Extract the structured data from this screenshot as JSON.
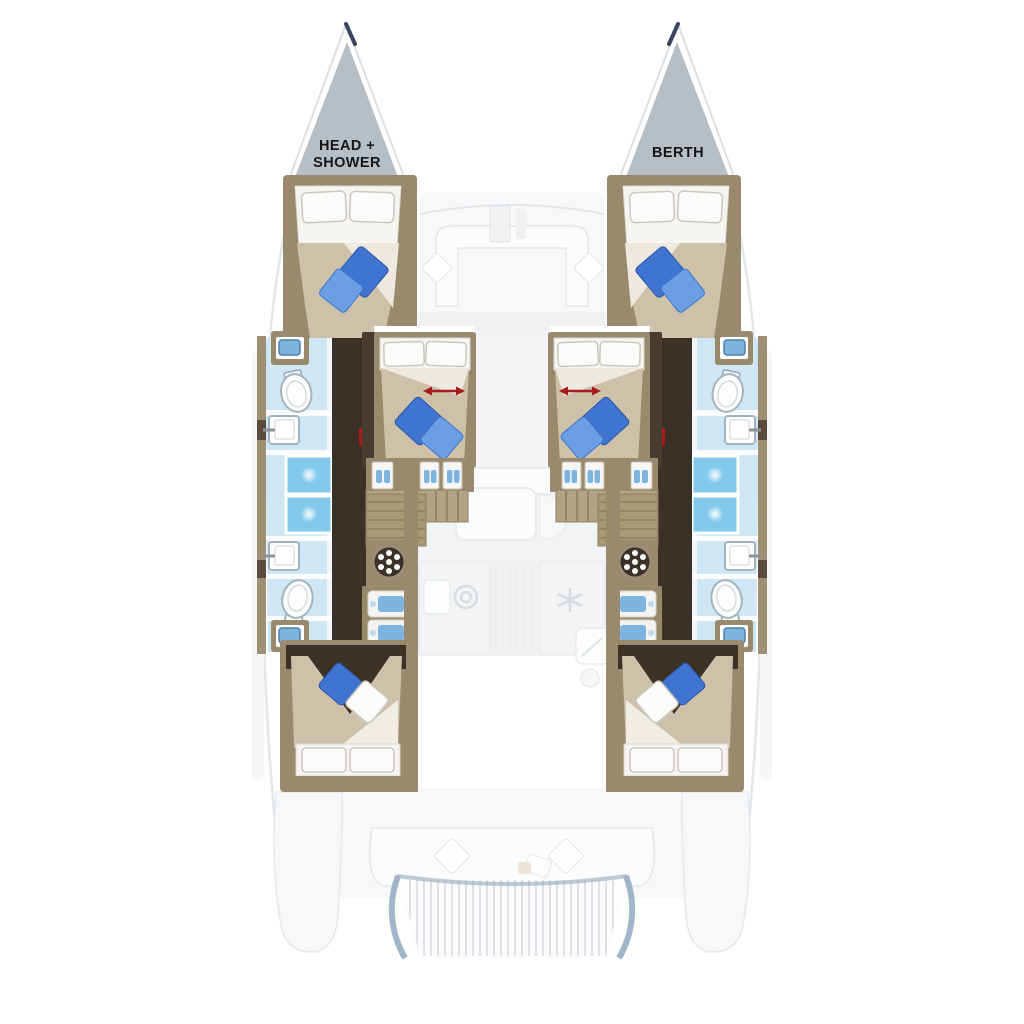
{
  "diagram": {
    "type": "boat-floorplan",
    "subject": "catamaran deck and hull layout, top view",
    "labels": {
      "bow_left_line1": "HEAD +",
      "bow_left_line2": "SHOWER",
      "bow_right": "BERTH"
    },
    "rooms_visible": [
      "port bow head + shower",
      "starboard bow berth",
      "port forward cabin",
      "starboard forward cabin",
      "port mid cabin",
      "starboard mid cabin",
      "port aft cabin",
      "starboard aft cabin",
      "port bathrooms",
      "starboard bathrooms",
      "saloon (ghosted)",
      "galley (ghosted)",
      "forward cockpit (ghosted)",
      "aft cockpit (ghosted)",
      "transom platform (ghosted)"
    ],
    "icons": {
      "toilet": "white oval with tank",
      "sink": "white square with faucet",
      "shower": "blue square with drain glow",
      "vanity-sink": "blue basin in tan cabinet",
      "washing-machine": "dark circle with white dots",
      "stairs": "tan treads",
      "bed": "pillows + beige duvet + blue cushions",
      "stove": "double circle burner",
      "fan": "snowflake asterisk",
      "red-arrow": "double-headed sliding-berth arrow"
    },
    "colors": {
      "background": "#ffffff",
      "bow_gray": "#b6bfc6",
      "wall_tan": "#9a8a6d",
      "wall_tan_dark": "#8a7a5e",
      "trim_dark": "#4a3b2f",
      "floor_dark": "#3c3127",
      "bath_floor_blue": "#cfe7f4",
      "shower_blue": "#82c9ec",
      "sink_blue": "#7db5e0",
      "duvet_beige": "#cec1a9",
      "pillow_white": "#fbfbfa",
      "pillow_blue": "#3f74d0",
      "pillow_blue_light": "#6b9fe2",
      "accent_red": "#a61b1b",
      "ghost": "#f2f3f5",
      "ghost_line": "#e4e7ea",
      "platform_edge": "#92a9bf",
      "label_text": "#151515"
    }
  }
}
